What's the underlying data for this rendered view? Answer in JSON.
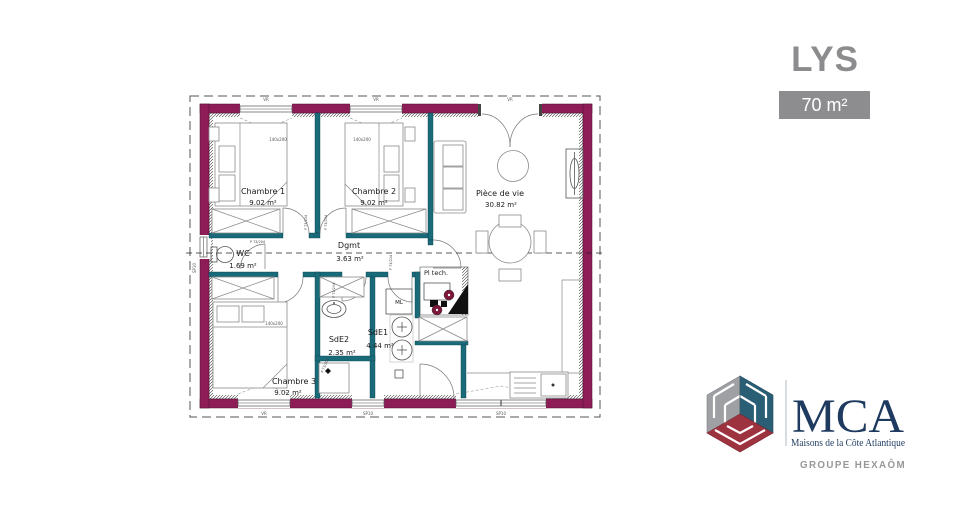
{
  "header": {
    "model_name": "LYS",
    "area_badge": "70 m²"
  },
  "floor_plan": {
    "rooms": [
      {
        "name": "Chambre 1",
        "area": "9.02 m²"
      },
      {
        "name": "Chambre 2",
        "area": "9.02 m²"
      },
      {
        "name": "Pièce de vie",
        "area": "30.82 m²"
      },
      {
        "name": "Dgmt",
        "area": "3.63 m²"
      },
      {
        "name": "WC",
        "area": "1.69 m²"
      },
      {
        "name": "SdE2",
        "area": "2.35 m²"
      },
      {
        "name": "SdE1",
        "area": "4.44 m²"
      },
      {
        "name": "Pl tech.",
        "area": ""
      },
      {
        "name": "Chambre 3",
        "area": "9.02 m²"
      }
    ],
    "annotations": {
      "bed_size": "140x200",
      "door_label": "P 73/204",
      "washing_machine": "ML",
      "shutter_label": "VR",
      "window_label": "SP10"
    },
    "colors": {
      "exterior_wall": "#8E1D57",
      "interior_wall": "#1A6B7A"
    }
  },
  "logo": {
    "acronym": "MCA",
    "full_name": "Maisons de la Côte Atlantique",
    "group": "GROUPE HEXAÔM",
    "colors": {
      "navy": "#1E3A5F",
      "red": "#9E3340",
      "gray": "#9FA0A3",
      "teal": "#2A5E74"
    }
  }
}
